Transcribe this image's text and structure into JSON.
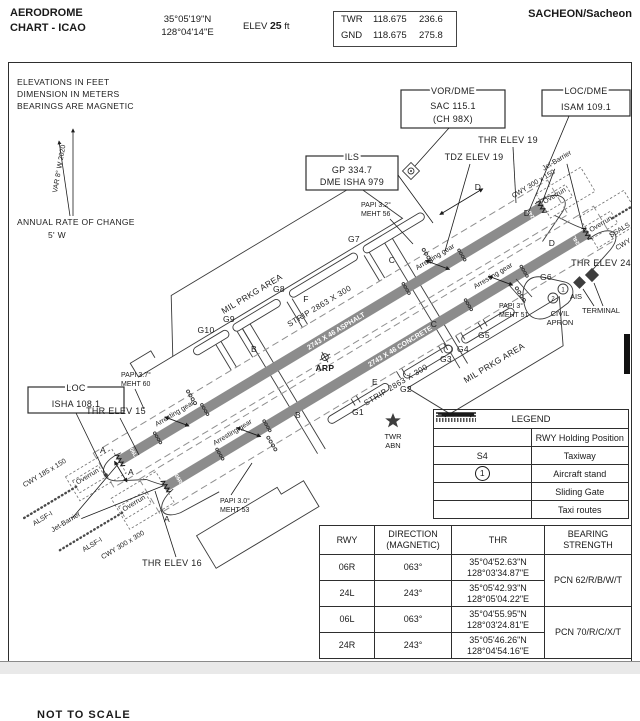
{
  "header": {
    "title1": "AERODROME",
    "title2": "CHART - ICAO",
    "lat": "35°05'19\"N",
    "lon": "128°04'14\"E",
    "elev_label": "ELEV",
    "elev_value": "25",
    "elev_unit": "ft",
    "twr_label": "TWR",
    "twr_f1": "118.675",
    "twr_f2": "236.6",
    "gnd_label": "GND",
    "gnd_f1": "118.675",
    "gnd_f2": "275.8",
    "name": "SACHEON/Sacheon"
  },
  "notes": {
    "l1": "ELEVATIONS IN FEET",
    "l2": "DIMENSION IN METERS",
    "l3": "BEARINGS ARE MAGNETIC",
    "var": "VAR 8° W 2020",
    "rate1": "ANNUAL RATE OF CHANGE",
    "rate2": "5' W"
  },
  "boxes": {
    "vor1": "VOR/DME",
    "vor2": "SAC 115.1",
    "vor3": "(CH 98X)",
    "ils1": "ILS",
    "ils2": "GP 334.7",
    "ils3": "DME ISHA 979",
    "locdme1": "LOC/DME",
    "locdme2": "ISAM 109.1",
    "loc1": "LOC",
    "loc2": "ISHA 108.1"
  },
  "map": {
    "thr19": "THR ELEV 19",
    "tdz19": "TDZ ELEV 19",
    "thr24": "THR ELEV 24",
    "thr15": "THR ELEV 15",
    "thr16": "THR ELEV 16",
    "papi32a": "PAPI  3.2°",
    "papi32b": "MEHT  56",
    "papi37a": "PAPI  3.7°",
    "papi37b": "MEHT  60",
    "papi30a": "PAPI  3.0°",
    "papi30b": "MEHT  53",
    "papi3a": "PAPI  3°",
    "papi3b": "MEHT  51",
    "ag": "Arresting  gear",
    "strip": "STRIP 2863 X 300",
    "rwy_n": "2743 X 46   ASPHALT",
    "rwy_s": "2743 X 46   CONCRETE",
    "mil": "MIL  PRKG  AREA",
    "cwy150": "CWY 300 x 150",
    "cwy185": "CWY 185 x 150",
    "cwy300": "CWY 300 x 300",
    "overrun": "Overrun",
    "alsf": "ALSF-I",
    "jet": "Jet-Barrier",
    "ssals": "SSALS",
    "arp": "ARP",
    "twr": "TWR",
    "abn": "ABN",
    "ais": "AIS",
    "terminal": "TERMINAL",
    "civil1": "CIVIL",
    "civil2": "APRON",
    "a": "A",
    "b": "B",
    "c": "C",
    "d": "D",
    "e": "E",
    "f": "F",
    "g1": "G1",
    "g2": "G2",
    "g3": "G3",
    "g4": "G4",
    "g5": "G5",
    "g6": "G6",
    "g7": "G7",
    "g8": "G8",
    "g9": "G9",
    "g10": "G10",
    "d06l": "06L",
    "d06r": "06R",
    "d24l": "24L",
    "d24r": "24R",
    "stand1": "1",
    "stand2": "2"
  },
  "legend": {
    "title": "LEGEND",
    "r1": "RWY Holding Position",
    "r2s": "S4",
    "r2": "Taxiway",
    "r3s": "1",
    "r3": "Aircraft stand",
    "r4": "Sliding Gate",
    "r5": "Taxi routes"
  },
  "rwy_table": {
    "h1": "RWY",
    "h2a": "DIRECTION",
    "h2b": "(MAGNETIC)",
    "h3": "THR",
    "h4a": "BEARING",
    "h4b": "STRENGTH",
    "rows": [
      {
        "rwy": "06R",
        "dir": "063°",
        "lat": "35°04'52.63\"N",
        "lon": "128°03'34.87\"E"
      },
      {
        "rwy": "24L",
        "dir": "243°",
        "lat": "35°05'42.93\"N",
        "lon": "128°05'04.22\"E"
      },
      {
        "rwy": "06L",
        "dir": "063°",
        "lat": "35°04'55.95\"N",
        "lon": "128°03'24.81\"E"
      },
      {
        "rwy": "24R",
        "dir": "243°",
        "lat": "35°05'46.26\"N",
        "lon": "128°04'54.16\"E"
      }
    ],
    "pcn1": "PCN 62/R/B/W/T",
    "pcn2": "PCN 70/R/C/X/T"
  },
  "footer": {
    "scale": "NOT  TO  SCALE"
  }
}
